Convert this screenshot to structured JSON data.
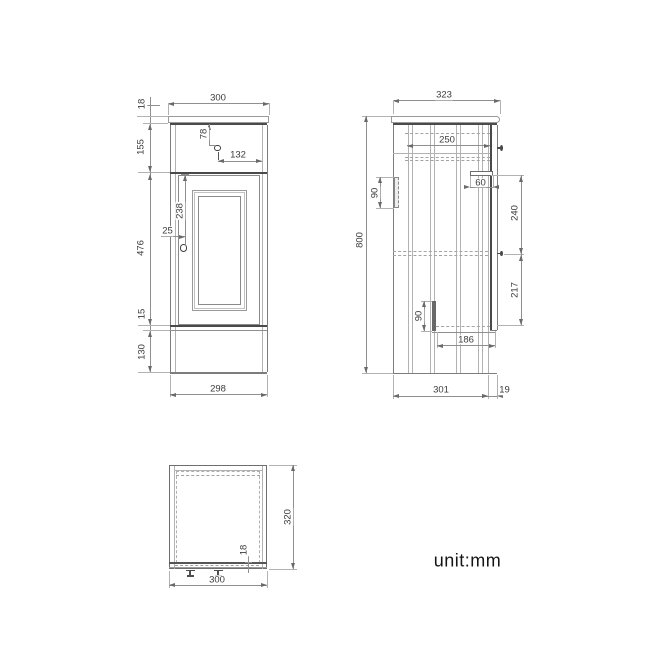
{
  "note": {
    "unit_label": "unit:mm"
  },
  "views": {
    "front": {
      "dims": {
        "top_width": "300",
        "counter_thickness": "18",
        "upper_section_height": "155",
        "drawer_knob_down": "78",
        "drawer_knob_right": "132",
        "door_knob_down": "238",
        "door_knob_in": "25",
        "door_section_height": "476",
        "bottom_rail": "15",
        "plinth_height": "130",
        "body_width": "298"
      }
    },
    "side": {
      "dims": {
        "top_depth": "323",
        "drawer_depth": "250",
        "upper_bracket": "90",
        "runner_length": "60",
        "upper_span": "240",
        "overall_height": "800",
        "lower_span": "217",
        "lower_bracket": "90",
        "shelf_span": "186",
        "body_depth": "301",
        "door_thickness": "19"
      }
    },
    "plan": {
      "dims": {
        "depth": "320",
        "front_thickness": "18",
        "width": "300"
      }
    }
  }
}
